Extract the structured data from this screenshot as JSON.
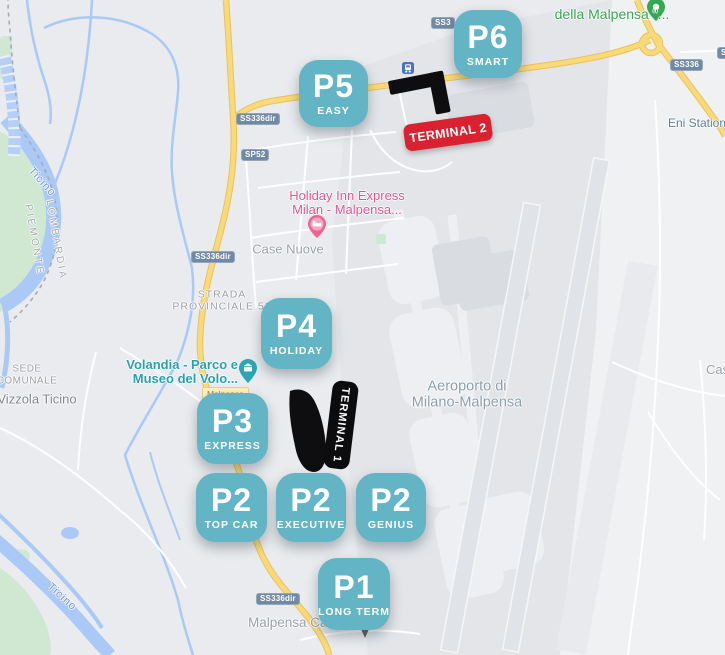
{
  "map_title": "Milano-Malpensa airport parking map",
  "colors": {
    "parking_teal": "#63b5c6",
    "terminal2_red": "#da2130",
    "terminal1_black": "#0c0c0e",
    "highway_yellow": "#f8da78",
    "water_blue": "#aac9f6",
    "park_green": "#d0e7d1",
    "shield_blue": "#7189a3"
  },
  "parkings": [
    {
      "code": "P6",
      "name": "SMART"
    },
    {
      "code": "P5",
      "name": "EASY"
    },
    {
      "code": "P4",
      "name": "HOLIDAY"
    },
    {
      "code": "P3",
      "name": "EXPRESS"
    },
    {
      "code": "P2",
      "name": "TOP CAR"
    },
    {
      "code": "P2",
      "name": "EXECUTIVE"
    },
    {
      "code": "P2",
      "name": "GENIUS"
    },
    {
      "code": "P1",
      "name": "LONG TERM"
    }
  ],
  "terminals": [
    {
      "label": "TERMINAL 2"
    },
    {
      "label": "TERMINAL 1"
    }
  ],
  "road_badges": [
    {
      "text": "SS3"
    },
    {
      "text": "SS336"
    },
    {
      "text": "S"
    },
    {
      "text": "SS336dir"
    },
    {
      "text": "SP52"
    },
    {
      "text": "SS336dir"
    },
    {
      "text": "SS336dir"
    }
  ],
  "road_name_label": "Malpensa",
  "labels": {
    "della_malpensa": "della Malpensa \"...",
    "eni_station": "Eni Station",
    "holiday_inn_line1": "Holiday Inn Express",
    "holiday_inn_line2": "Milan - Malpensa...",
    "case_nuove": "Case Nuove",
    "strada_line1": "STRADA",
    "strada_line2": "PROVINCIALE 52",
    "volandia_line1": "Volandia - Parco e",
    "volandia_line2": "Museo del Volo...",
    "airport_line1": "Aeroporto di",
    "airport_line2": "Milano-Malpensa",
    "sede_line1": "SEDE",
    "sede_line2": "COMUNALE",
    "vizzola": "Vizzola Ticino",
    "lombardia": "LOMBARDIA",
    "piemonte": "PIEMONTE",
    "ticino_top": "Ticino",
    "ticino_bottom": "Ticino",
    "malpensa_ca": "Malpensa Ca",
    "cas_cut": "Cas"
  }
}
